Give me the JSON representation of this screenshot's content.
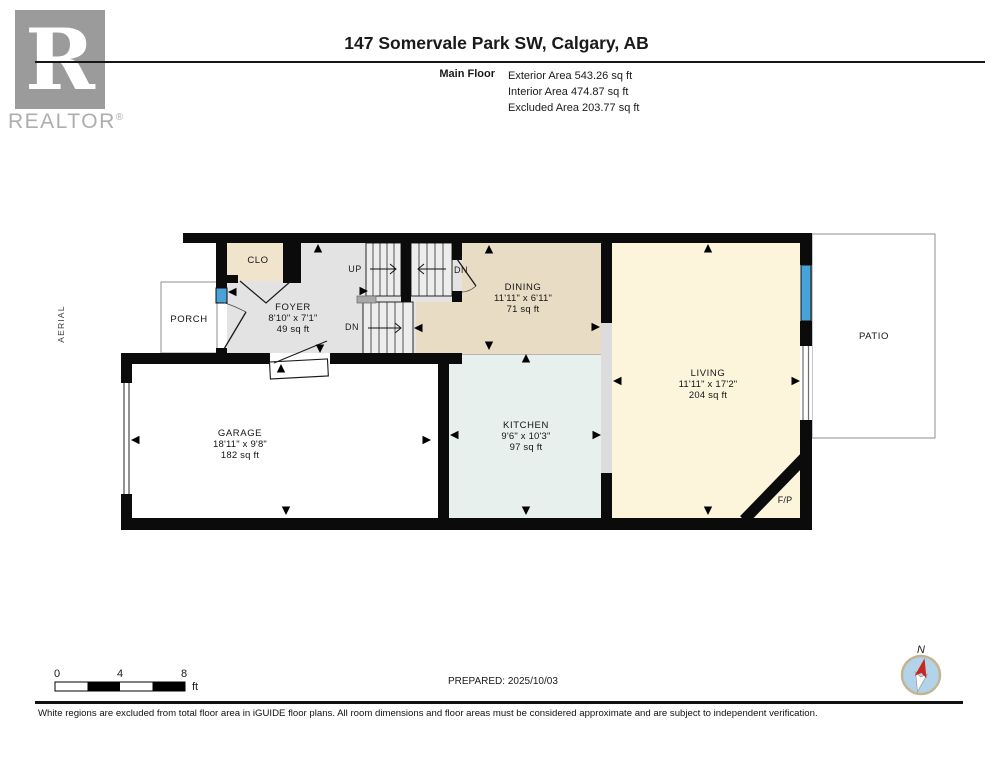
{
  "header": {
    "logo": {
      "letter": "R",
      "brand": "REALTOR",
      "registered": "®"
    },
    "title": "147 Somervale Park SW, Calgary, AB",
    "floor_label": "Main Floor",
    "areas": [
      "Exterior Area 543.26 sq ft",
      "Interior Area 474.87 sq ft",
      "Excluded Area 203.77 sq ft"
    ]
  },
  "plan": {
    "aerial_label": "AERIAL",
    "stairs": {
      "up": "UP",
      "dn": "DN"
    },
    "rooms": {
      "clo": {
        "name": "CLO"
      },
      "foyer": {
        "name": "FOYER",
        "dims": "8'10\" x 7'1\"",
        "area": "49 sq ft"
      },
      "porch": {
        "name": "PORCH"
      },
      "dining": {
        "name": "DINING",
        "dims": "11'11\" x 6'11\"",
        "area": "71 sq ft"
      },
      "kitchen": {
        "name": "KITCHEN",
        "dims": "9'6\" x 10'3\"",
        "area": "97 sq ft"
      },
      "living": {
        "name": "LIVING",
        "dims": "11'11\" x 17'2\"",
        "area": "204 sq ft"
      },
      "garage": {
        "name": "GARAGE",
        "dims": "18'11\" x 9'8\"",
        "area": "182 sq ft"
      },
      "patio": {
        "name": "PATIO"
      },
      "fireplace": {
        "name": "F/P"
      }
    }
  },
  "footer": {
    "scale_ticks": [
      "0",
      "4",
      "8"
    ],
    "scale_unit": "ft",
    "prepared": "PREPARED: 2025/10/03",
    "compass": "N",
    "disclaimer": "White regions are excluded from total floor area in iGUIDE floor plans. All room dimensions and floor areas must be considered approximate and are subject to independent verification."
  },
  "colors": {
    "wall": "#0b0b0b",
    "window_blue": "#4aa3d8",
    "foyer_floor": "#e3e3e3",
    "dining_floor": "#e9dcc4",
    "closet_floor": "#f1e4cc",
    "living_floor": "#fcf5dc",
    "kitchen_floor": "#e7f0ec",
    "compass_fill": "#b3d3e9",
    "needle_red": "#c8271f"
  }
}
